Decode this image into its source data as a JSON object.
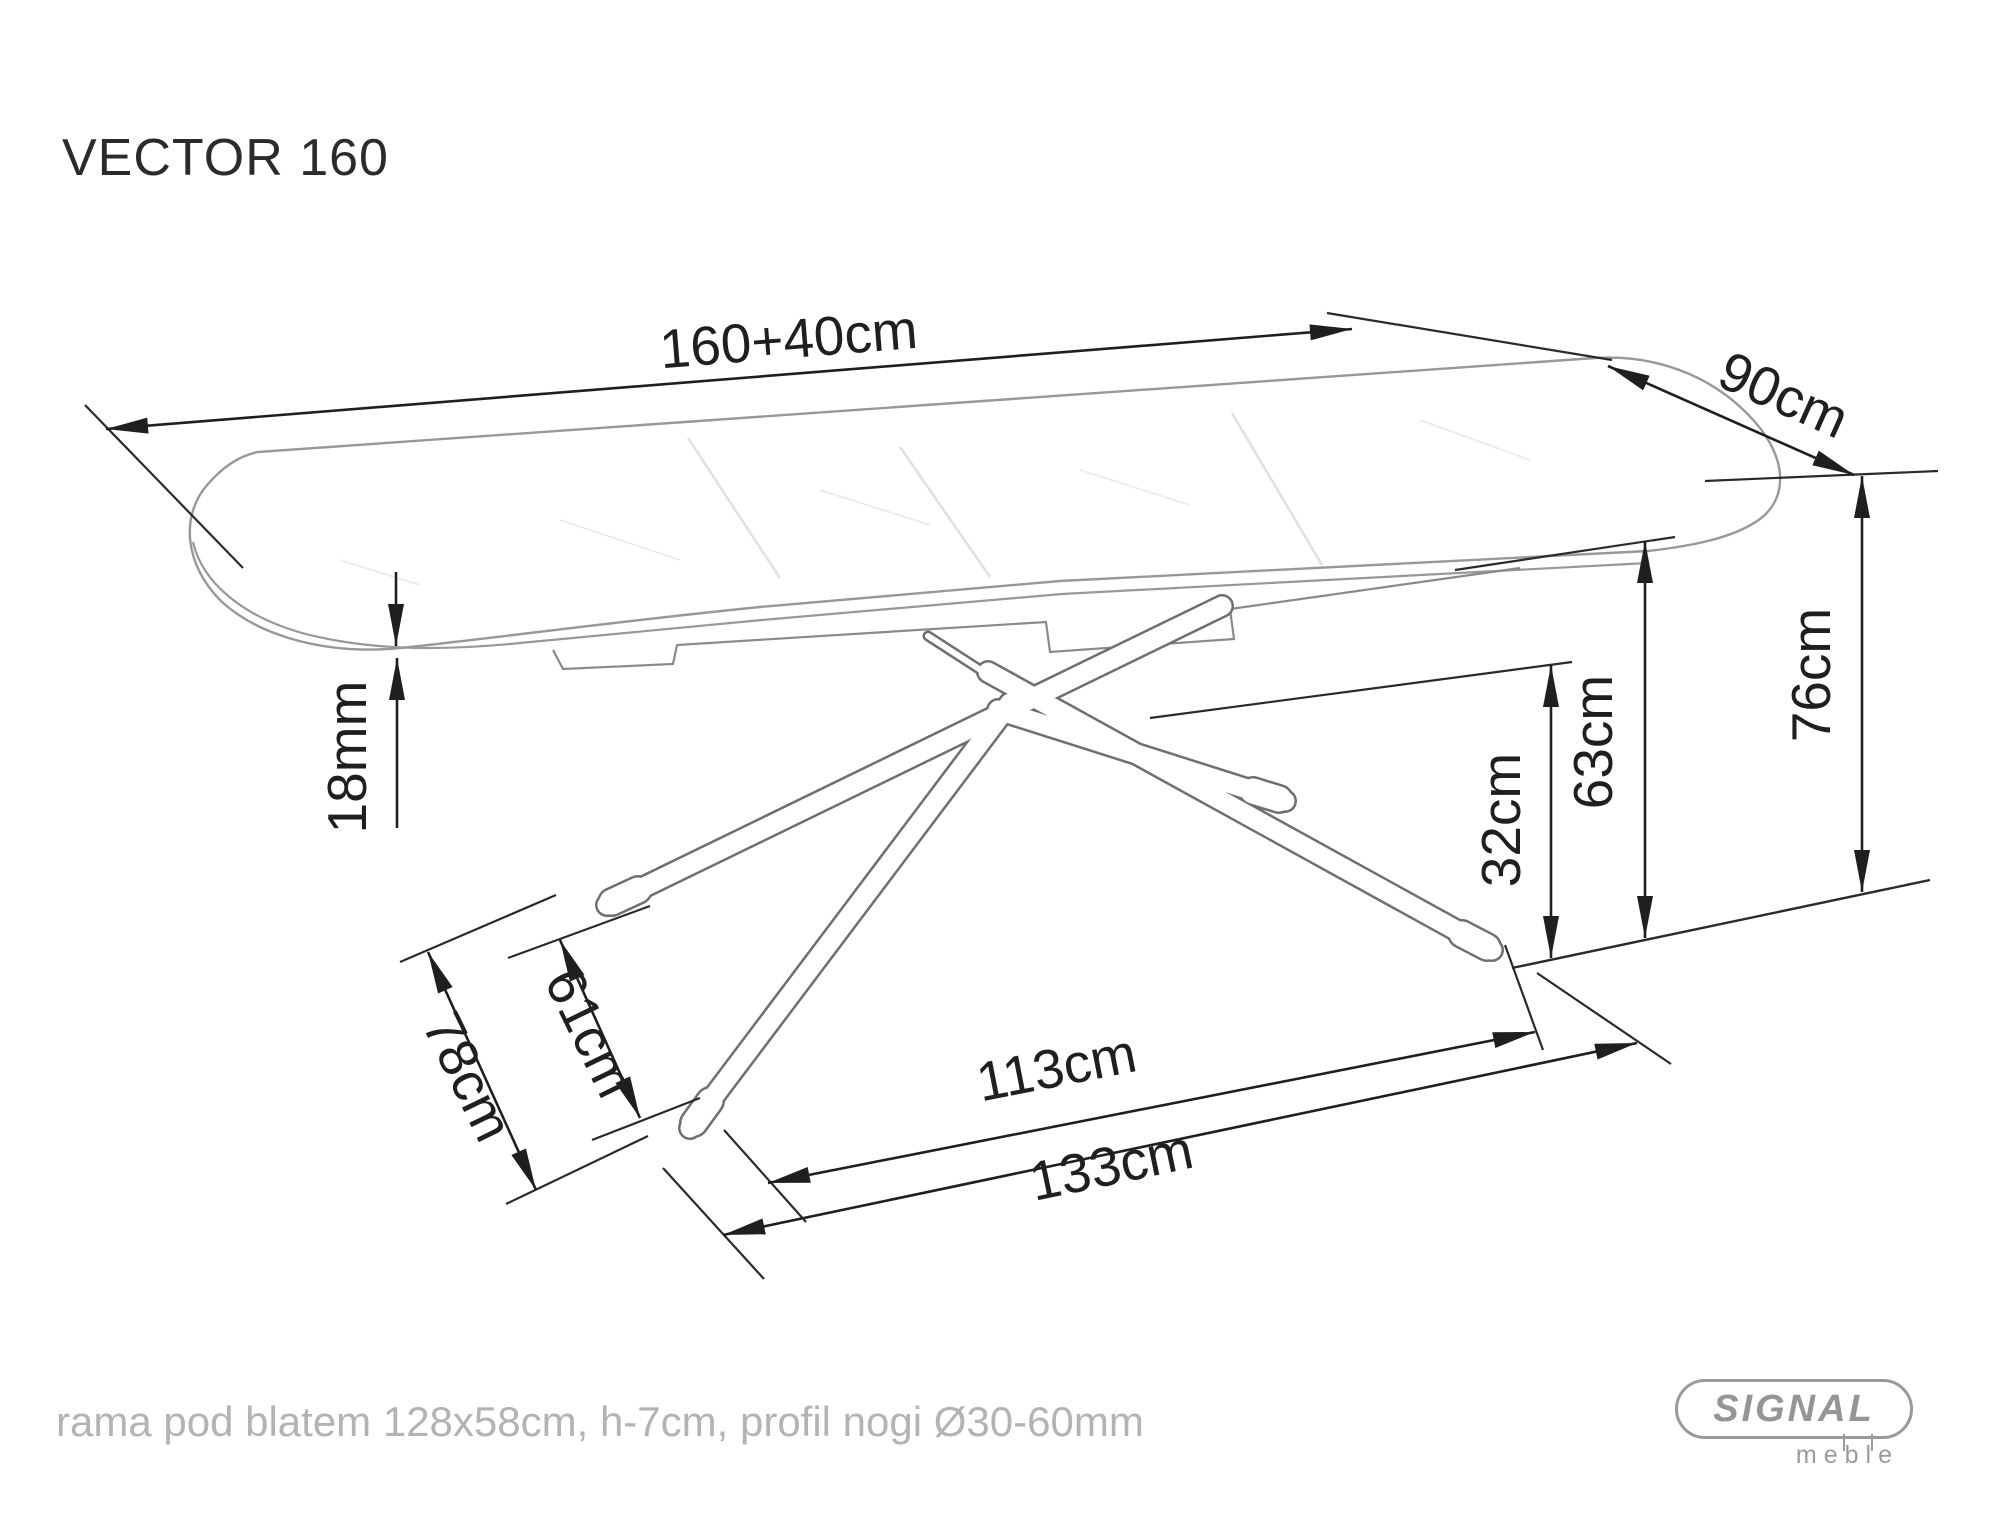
{
  "page": {
    "title": "VECTOR 160",
    "footnote": "rama pod blatem 128x58cm, h-7cm, profil nogi Ø30-60mm",
    "background": "#ffffff"
  },
  "logo": {
    "brand": "SIGNAL",
    "sub_brand": "meble"
  },
  "diagram": {
    "type": "technical-drawing",
    "subject": "extendable dining table",
    "dimension_color": "#1f1f1f",
    "drawing_color": "#8e8e8e",
    "dimensions": {
      "length": "160+40cm",
      "width": "90cm",
      "top_thickness": "18mm",
      "height": "76cm",
      "underframe_height": "63cm",
      "hub_height": "32cm",
      "foot_span_depth_outer": "78cm",
      "foot_span_depth_inner": "61cm",
      "foot_span_length_inner": "113cm",
      "foot_span_length_outer": "133cm"
    }
  }
}
